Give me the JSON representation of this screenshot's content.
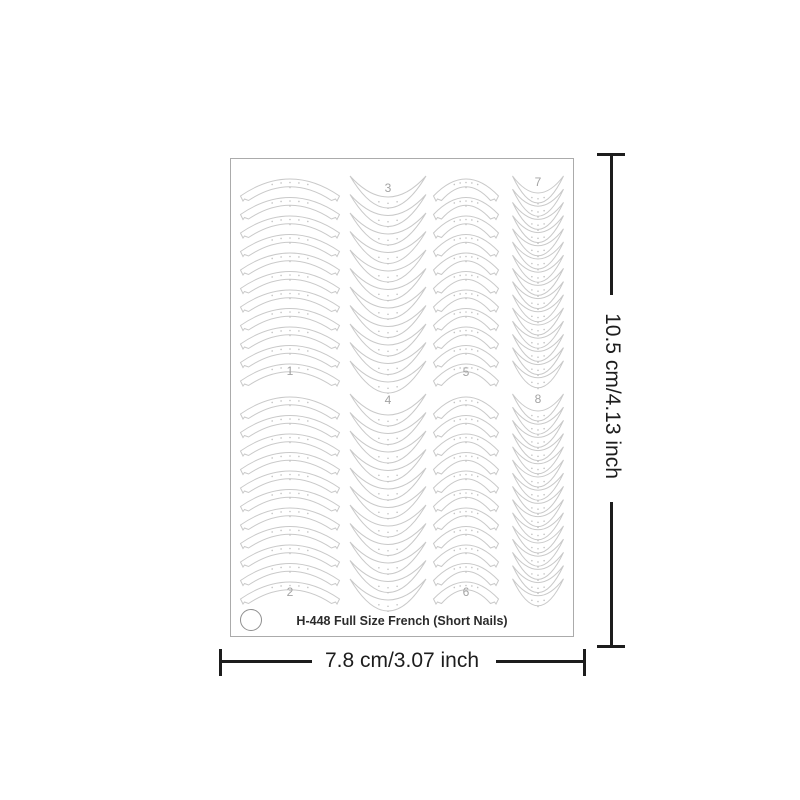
{
  "sheet": {
    "label": "H-448 Full Size French (Short Nails)",
    "columns": [
      {
        "number": "1",
        "style": "arch",
        "count": 11,
        "cx": 59,
        "width": 99,
        "start_y": 15,
        "spacing": 18.5,
        "label_pos": "bottom"
      },
      {
        "number": "2",
        "style": "arch",
        "count": 11,
        "cx": 59,
        "width": 99,
        "start_y": 233,
        "spacing": 18.5,
        "label_pos": "bottom"
      },
      {
        "number": "3",
        "style": "crescent",
        "count": 11,
        "cx": 157,
        "width": 76,
        "start_y": 17,
        "spacing": 18.5,
        "d_in": 21,
        "d_out": 32,
        "label_pos": "top"
      },
      {
        "number": "4",
        "style": "crescent",
        "count": 11,
        "cx": 157,
        "width": 76,
        "start_y": 235,
        "spacing": 18.5,
        "d_in": 21,
        "d_out": 32,
        "label_pos": "top"
      },
      {
        "number": "5",
        "style": "arch",
        "count": 11,
        "cx": 235,
        "width": 65,
        "start_y": 15,
        "spacing": 18.5,
        "label_pos": "bottom"
      },
      {
        "number": "6",
        "style": "arch",
        "count": 11,
        "cx": 235,
        "width": 65,
        "start_y": 233,
        "spacing": 18.5,
        "label_pos": "bottom"
      },
      {
        "number": "7",
        "style": "crescent",
        "count": 15,
        "cx": 307,
        "width": 51,
        "start_y": 17,
        "spacing": 13.2,
        "d_in": 17,
        "d_out": 27,
        "label_pos": "top"
      },
      {
        "number": "8",
        "style": "crescent",
        "count": 15,
        "cx": 307,
        "width": 51,
        "start_y": 235,
        "spacing": 13.2,
        "d_in": 17,
        "d_out": 27,
        "label_pos": "top"
      }
    ]
  },
  "dimensions": {
    "height_label": "10.5 cm/4.13 inch",
    "width_label": "7.8 cm/3.07 inch"
  },
  "colors": {
    "sticker_outline": "#c9c9c9",
    "sticker_fill": "#ffffff",
    "dot": "#c4c4c4",
    "column_number": "#a3a3a3",
    "sheet_border": "#ababab",
    "dimension": "#1d1d1d",
    "label_text": "#2b2b2b"
  }
}
